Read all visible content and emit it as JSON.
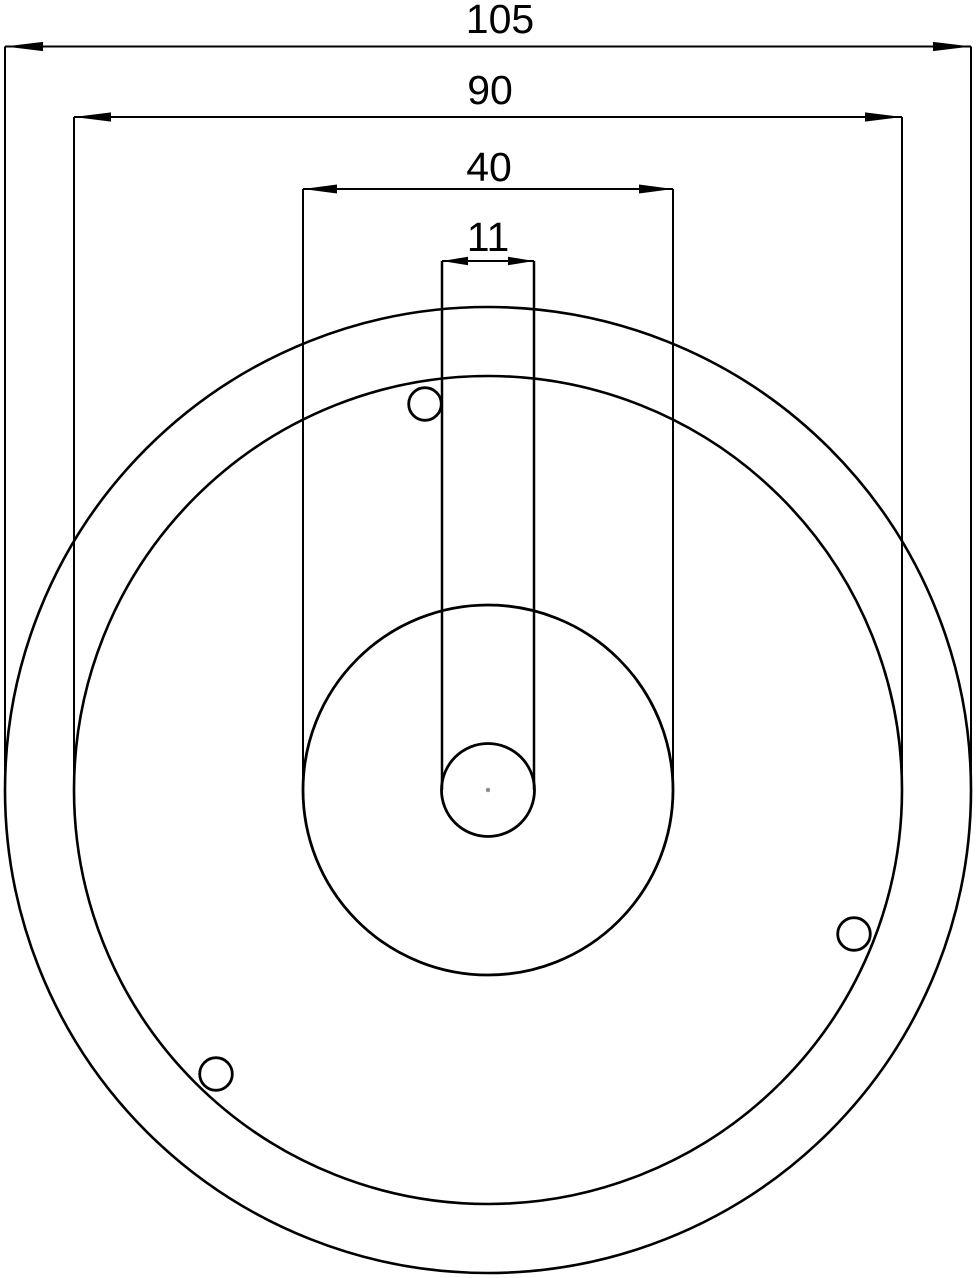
{
  "drawing": {
    "canvas": {
      "width": 976,
      "height": 1278
    },
    "background_color": "#ffffff",
    "line_color": "#000000",
    "center_mark_color": "#8c8c8c",
    "label_font_size": 41,
    "center": {
      "x": 488,
      "y": 790
    },
    "circles": [
      {
        "name": "outer-diameter-circle",
        "r": 483,
        "stroke_width": 2.6
      },
      {
        "name": "flange-diameter-circle",
        "r": 414,
        "stroke_width": 2.6
      },
      {
        "name": "hub-diameter-circle",
        "r": 185,
        "stroke_width": 2.8
      },
      {
        "name": "center-bore-circle",
        "r": 46.5,
        "stroke_width": 2.8
      }
    ],
    "holes": [
      {
        "name": "mounting-hole-top",
        "x": 425,
        "y": 404,
        "r": 16.3,
        "stroke_width": 2.8
      },
      {
        "name": "mounting-hole-right",
        "x": 854,
        "y": 934,
        "r": 16.3,
        "stroke_width": 2.8
      },
      {
        "name": "mounting-hole-bottom-left",
        "x": 216,
        "y": 1074,
        "r": 16.3,
        "stroke_width": 2.8
      }
    ],
    "slot": {
      "x_left": 442,
      "x_right": 534,
      "y_top": 261,
      "y_bottom": 790,
      "stroke_width": 2.5
    },
    "center_mark": {
      "x": 488,
      "y": 790,
      "r": 2.2
    },
    "dimensions": [
      {
        "label": "105",
        "line_y": 46.5,
        "x1": 5,
        "x2": 971,
        "text_x": 500,
        "text_baseline_y": 33,
        "ext_bottom_y": 790,
        "draw_ext": true,
        "arrow_len": 38,
        "arrow_halfwidth": 4.6,
        "stroke_width": 2
      },
      {
        "label": "90",
        "line_y": 117,
        "x1": 74,
        "x2": 902,
        "text_x": 490,
        "text_baseline_y": 104,
        "ext_bottom_y": 790,
        "draw_ext": true,
        "arrow_len": 37,
        "arrow_halfwidth": 4.6,
        "stroke_width": 2
      },
      {
        "label": "40",
        "line_y": 189,
        "x1": 303,
        "x2": 673,
        "text_x": 489,
        "text_baseline_y": 181,
        "ext_bottom_y": 790,
        "draw_ext": true,
        "arrow_len": 34,
        "arrow_halfwidth": 4.5,
        "stroke_width": 2
      },
      {
        "label": "11",
        "line_y": 261,
        "x1": 442,
        "x2": 534,
        "text_x": 488,
        "text_baseline_y": 251,
        "ext_bottom_y": 790,
        "draw_ext": false,
        "arrow_len": 26,
        "arrow_halfwidth": 4.2,
        "stroke_width": 2
      }
    ]
  }
}
